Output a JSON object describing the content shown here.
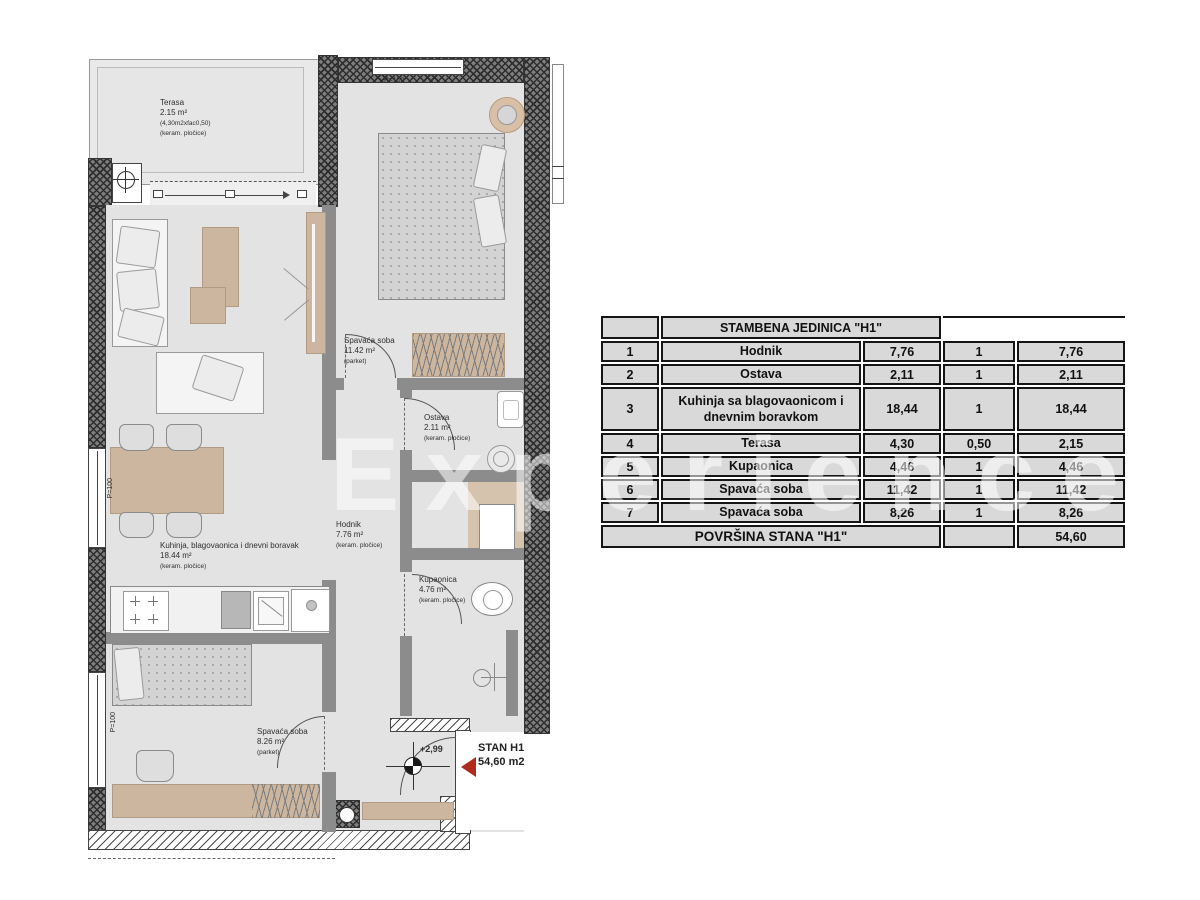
{
  "watermark": "Experience",
  "plan": {
    "terrace": {
      "name": "Terasa",
      "area": "2.15 m²",
      "calc": "(4,30m2xfac0,50)",
      "floor": "(keram. pločice)"
    },
    "bedroom1": {
      "name": "Spavaća soba",
      "area": "11.42 m²",
      "floor": "(parket)"
    },
    "ostava": {
      "name": "Ostava",
      "area": "2.11 m²",
      "floor": "(keram. pločice)"
    },
    "kitchen": {
      "name": "Kuhinja, blagovaonica i dnevni boravak",
      "area": "18.44 m²",
      "floor": "(keram. pločice)"
    },
    "hodnik": {
      "name": "Hodnik",
      "area": "7.76 m²",
      "floor": "(keram. pločice)"
    },
    "kupaonica": {
      "name": "Kupaonica",
      "area": "4.76 m²",
      "floor": "(keram. pločice)"
    },
    "bedroom2": {
      "name": "Spavaća soba",
      "area": "8.26 m²",
      "floor": "(parket)"
    },
    "parapet": "P=100",
    "level": "+2,99",
    "unit": {
      "label": "STAN H1",
      "area": "54,60 m2"
    }
  },
  "table": {
    "title": "STAMBENA JEDINICA \"H1\"",
    "rows": [
      {
        "num": "1",
        "name": "Hodnik",
        "name2": "",
        "area": "7,76",
        "factor": "1",
        "total": "7,76"
      },
      {
        "num": "2",
        "name": "Ostava",
        "name2": "",
        "area": "2,11",
        "factor": "1",
        "total": "2,11"
      },
      {
        "num": "3",
        "name": "Kuhinja sa blagovaonicom i",
        "name2": "dnevnim boravkom",
        "area": "18,44",
        "factor": "1",
        "total": "18,44"
      },
      {
        "num": "4",
        "name": "Terasa",
        "name2": "",
        "area": "4,30",
        "factor": "0,50",
        "total": "2,15"
      },
      {
        "num": "5",
        "name": "Kupaonica",
        "name2": "",
        "area": "4,46",
        "factor": "1",
        "total": "4,46"
      },
      {
        "num": "6",
        "name": "Spavaća soba",
        "name2": "",
        "area": "11,42",
        "factor": "1",
        "total": "11,42"
      },
      {
        "num": "7",
        "name": "Spavaća soba",
        "name2": "",
        "area": "8,26",
        "factor": "1",
        "total": "8,26"
      }
    ],
    "footer": {
      "label": "POVRŠINA STANA \"H1\"",
      "total": "54,60"
    }
  },
  "colors": {
    "wall_gray": "#8c8c8c",
    "entrance_arrow_red": "#b02a1e",
    "furniture_tan": "#cdb6a0",
    "table_cell_gray": "#d9d9d9"
  }
}
